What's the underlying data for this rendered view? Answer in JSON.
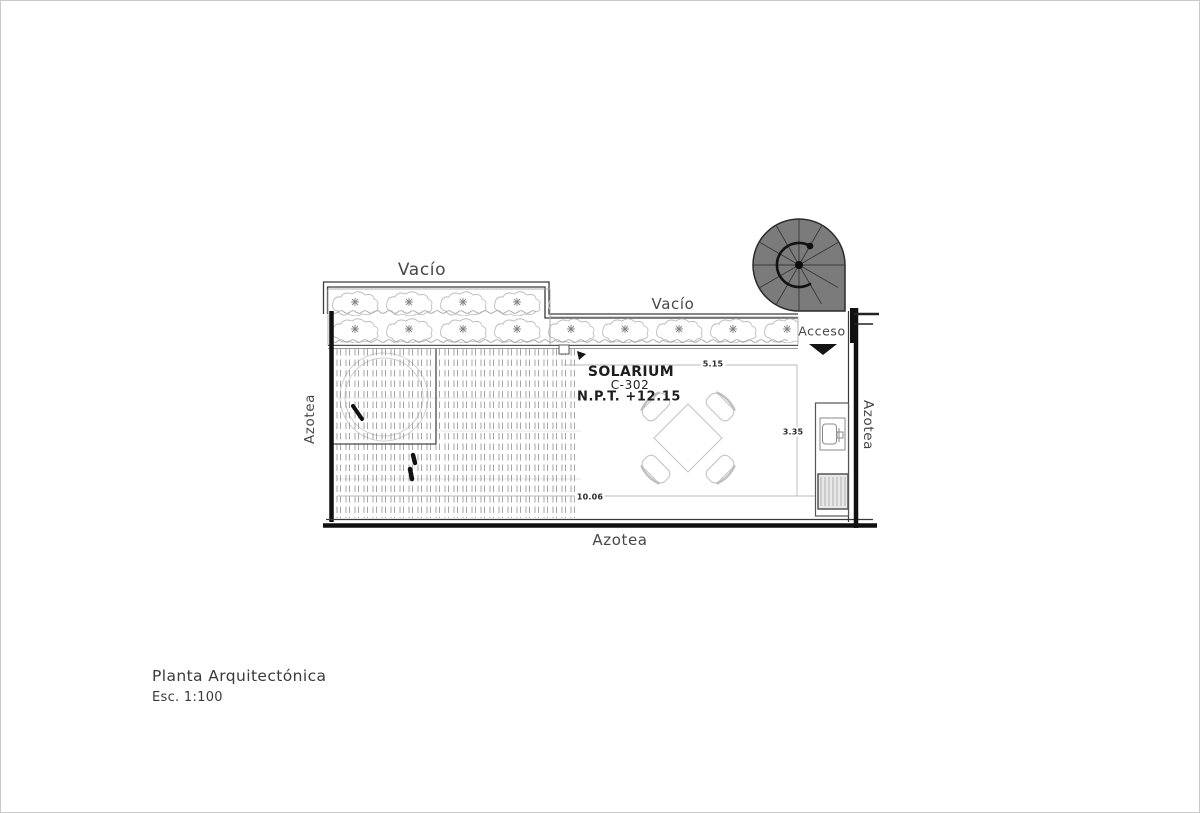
{
  "drawing": {
    "labels": {
      "vacio_top": "Vacío",
      "vacio_right": "Vacío",
      "acceso": "Acceso",
      "azotea_left": "Azotea",
      "azotea_right": "Azotea",
      "azotea_bottom": "Azotea"
    },
    "room": {
      "name": "SOLARIUM",
      "number": "C-302",
      "level": "N.P.T. +12.15"
    },
    "dimensions": {
      "top": "5.15",
      "right": "3.35",
      "bottom": "10.06"
    },
    "title_block": {
      "title": "Planta Arquitectónica",
      "scale": "Esc. 1:100"
    },
    "colors": {
      "ink": "#1c1c1c",
      "wall": "#101010",
      "line_medium": "#4a4a4a",
      "line_light": "#c9c9c9",
      "construction": "#bdbdbd",
      "dash": "#8f8f8f",
      "plant": "#b5b5b5",
      "stair_fill": "#7b7b7b",
      "text": "#474747"
    }
  }
}
